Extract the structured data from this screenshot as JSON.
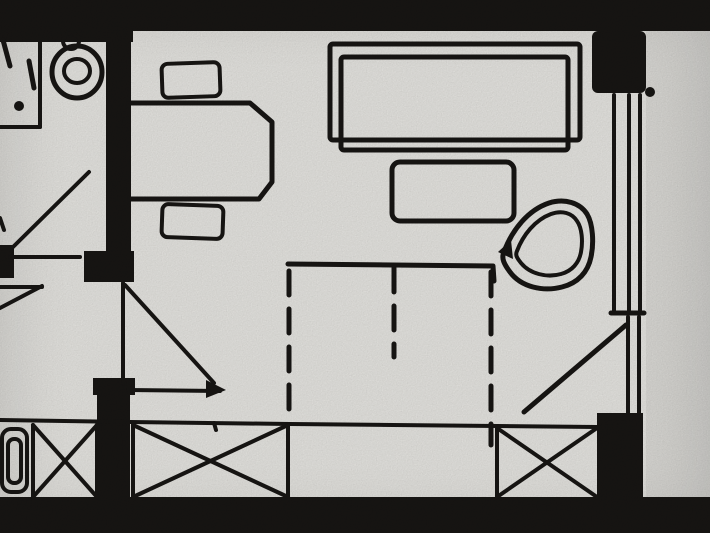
{
  "meta": {
    "title": "Scanned hand-drawn floor plan",
    "width": 710,
    "height": 533
  },
  "palette": {
    "paper": "#e9e8e4",
    "ink": "#181614",
    "right_strip": "rgba(20,18,16,0.05)"
  },
  "floor_plan": {
    "overlays": [
      {
        "name": "adjacent-bay-shading",
        "x": 646,
        "y": 31,
        "w": 64,
        "h": 466,
        "fill": "rgba(20,18,16,0.05)"
      }
    ],
    "walls": [
      {
        "name": "top-wall",
        "x": 0,
        "y": 0,
        "w": 710,
        "h": 31
      },
      {
        "name": "top-wall-left-thick",
        "x": 0,
        "y": 0,
        "w": 133,
        "h": 42
      },
      {
        "name": "window-pier-top",
        "x": 592,
        "y": 31,
        "w": 54,
        "h": 62,
        "rx": 6
      },
      {
        "name": "bath-room-divider-wall",
        "x": 106,
        "y": 31,
        "w": 25,
        "h": 223
      },
      {
        "name": "bath-door-jamb-right",
        "x": 84,
        "y": 251,
        "w": 50,
        "h": 31
      },
      {
        "name": "bath-door-jamb-left",
        "x": 0,
        "y": 245,
        "w": 14,
        "h": 33
      },
      {
        "name": "hall-room-wall-cap",
        "x": 93,
        "y": 378,
        "w": 42,
        "h": 17
      },
      {
        "name": "hall-room-wall",
        "x": 97,
        "y": 378,
        "w": 33,
        "h": 122
      },
      {
        "name": "balcony-pier-right",
        "x": 597,
        "y": 413,
        "w": 46,
        "h": 86
      },
      {
        "name": "bottom-wall",
        "x": 0,
        "y": 497,
        "w": 710,
        "h": 36
      }
    ],
    "strokes": [
      {
        "name": "bath-cubicle-side-line",
        "kind": "line",
        "x1": 40,
        "y1": 42,
        "x2": 40,
        "y2": 127,
        "w": 4
      },
      {
        "name": "bath-cubicle-bottom-line",
        "kind": "line",
        "x1": 0,
        "y1": 127,
        "x2": 40,
        "y2": 127,
        "w": 4
      },
      {
        "name": "toilet-fixture-mark-1",
        "kind": "line",
        "x1": 3,
        "y1": 40,
        "x2": 10,
        "y2": 66,
        "w": 5
      },
      {
        "name": "toilet-fixture-mark-2",
        "kind": "line",
        "x1": 29,
        "y1": 61,
        "x2": 34,
        "y2": 88,
        "w": 5
      },
      {
        "name": "washbasin-outer-bowl",
        "kind": "ellipse",
        "cx": 77,
        "cy": 72,
        "rx": 25,
        "ry": 26,
        "w": 5
      },
      {
        "name": "washbasin-inner-bowl",
        "kind": "ellipse",
        "cx": 77,
        "cy": 71,
        "rx": 13,
        "ry": 12,
        "w": 4
      },
      {
        "name": "washbasin-faucet",
        "kind": "ellipse",
        "cx": 71,
        "cy": 41,
        "rx": 8,
        "ry": 8,
        "w": 4
      },
      {
        "name": "bath-wall-edge-mark",
        "kind": "line",
        "x1": 0,
        "y1": 218,
        "x2": 4,
        "y2": 230,
        "w": 4
      },
      {
        "name": "bath-door-leaf",
        "kind": "line",
        "x1": 89,
        "y1": 172,
        "x2": 12,
        "y2": 248,
        "w": 4
      },
      {
        "name": "bath-door-chord",
        "kind": "line",
        "x1": 10,
        "y1": 257,
        "x2": 80,
        "y2": 257,
        "w": 4
      },
      {
        "name": "entry-door-chord",
        "kind": "line",
        "x1": 0,
        "y1": 287,
        "x2": 42,
        "y2": 287,
        "w": 4
      },
      {
        "name": "entry-door-swing",
        "kind": "line",
        "x1": 42,
        "y1": 286,
        "x2": 0,
        "y2": 308,
        "w": 4
      },
      {
        "name": "desk-outline",
        "kind": "path",
        "d": "M131,103 L250,103 L272,122 L272,182 L259,199 L131,199",
        "w": 5
      },
      {
        "name": "desk-chair-top",
        "kind": "rect",
        "x": 162,
        "y": 63,
        "w": 58,
        "h": 34,
        "rx": 6,
        "sw": 4,
        "rot": [
          -2,
          191,
          80
        ]
      },
      {
        "name": "desk-chair-bottom",
        "kind": "rect",
        "x": 162,
        "y": 205,
        "w": 61,
        "h": 33,
        "rx": 6,
        "sw": 4,
        "rot": [
          2,
          192,
          221
        ]
      },
      {
        "name": "sofa-outer-outline",
        "kind": "rect",
        "x": 330,
        "y": 44,
        "w": 250,
        "h": 96,
        "rx": 3,
        "sw": 5
      },
      {
        "name": "sofa-inner-outline",
        "kind": "rect",
        "x": 341,
        "y": 57,
        "w": 227,
        "h": 93,
        "rx": 3,
        "sw": 5
      },
      {
        "name": "side-table-outline",
        "kind": "rect",
        "x": 392,
        "y": 162,
        "w": 122,
        "h": 59,
        "rx": 8,
        "sw": 5
      },
      {
        "name": "armchair-outer-shell",
        "kind": "path",
        "d": "M504,252 C512,230 528,210 549,203 C565,198 580,203 587,214 C593,224 594,243 591,257 C588,272 578,283 562,287 C543,292 521,287 510,272 C504,264 501,258 504,252 Z",
        "w": 5
      },
      {
        "name": "armchair-inner-shell",
        "kind": "path",
        "d": "M517,251 C523,235 535,220 551,214 C562,210 572,213 577,221 C582,228 583,241 581,252 C579,263 572,271 561,274 C547,278 530,274 521,263 C517,258 515,255 517,251 Z",
        "w": 4
      },
      {
        "name": "window-glazing-line-1",
        "kind": "line",
        "x1": 614,
        "y1": 95,
        "x2": 614,
        "y2": 311,
        "w": 4
      },
      {
        "name": "window-glazing-line-2",
        "kind": "line",
        "x1": 629,
        "y1": 95,
        "x2": 629,
        "y2": 311,
        "w": 4
      },
      {
        "name": "window-glazing-line-3",
        "kind": "line",
        "x1": 640,
        "y1": 95,
        "x2": 640,
        "y2": 311,
        "w": 4
      },
      {
        "name": "window-sill-tick",
        "kind": "line",
        "x1": 611,
        "y1": 313,
        "x2": 644,
        "y2": 313,
        "w": 5
      },
      {
        "name": "balcony-door-frame-1",
        "kind": "line",
        "x1": 628,
        "y1": 317,
        "x2": 628,
        "y2": 413,
        "w": 4
      },
      {
        "name": "balcony-door-frame-2",
        "kind": "line",
        "x1": 639,
        "y1": 317,
        "x2": 639,
        "y2": 413,
        "w": 4
      },
      {
        "name": "balcony-door-swing",
        "kind": "line",
        "x1": 626,
        "y1": 325,
        "x2": 524,
        "y2": 412,
        "w": 5
      },
      {
        "name": "bed-head-edge",
        "kind": "polyline",
        "pts": "288,264 493,266 494,281",
        "w": 5
      },
      {
        "name": "bed-dashed-left-edge",
        "kind": "line",
        "x1": 289,
        "y1": 271,
        "x2": 289,
        "y2": 420,
        "w": 5,
        "dash": "24 14"
      },
      {
        "name": "bed-dashed-center-divider",
        "kind": "line",
        "x1": 394,
        "y1": 268,
        "x2": 394,
        "y2": 357,
        "w": 5,
        "dash": "24 14"
      },
      {
        "name": "bed-dashed-right-edge",
        "kind": "line",
        "x1": 491,
        "y1": 272,
        "x2": 491,
        "y2": 445,
        "w": 5,
        "dash": "24 14"
      },
      {
        "name": "balcony-rail-line",
        "kind": "polyline",
        "pts": "0,420 130,422 290,424 597,427",
        "w": 4
      },
      {
        "name": "rail-pen-mark",
        "kind": "line",
        "x1": 214,
        "y1": 423,
        "x2": 216,
        "y2": 430,
        "w": 4
      },
      {
        "name": "railing-panel-1-left",
        "kind": "line",
        "x1": 33,
        "y1": 425,
        "x2": 33,
        "y2": 497,
        "w": 4
      },
      {
        "name": "railing-panel-1-right",
        "kind": "line",
        "x1": 97,
        "y1": 425,
        "x2": 97,
        "y2": 497,
        "w": 4
      },
      {
        "name": "railing-panel-1-cross-a",
        "kind": "line",
        "x1": 33,
        "y1": 425,
        "x2": 97,
        "y2": 497,
        "w": 4
      },
      {
        "name": "railing-panel-1-cross-b",
        "kind": "line",
        "x1": 97,
        "y1": 425,
        "x2": 33,
        "y2": 497,
        "w": 4
      },
      {
        "name": "railing-panel-2-left",
        "kind": "line",
        "x1": 133,
        "y1": 425,
        "x2": 133,
        "y2": 497,
        "w": 4
      },
      {
        "name": "railing-panel-2-right",
        "kind": "line",
        "x1": 288,
        "y1": 425,
        "x2": 288,
        "y2": 497,
        "w": 4
      },
      {
        "name": "railing-panel-2-cross-a",
        "kind": "line",
        "x1": 133,
        "y1": 425,
        "x2": 288,
        "y2": 497,
        "w": 4
      },
      {
        "name": "railing-panel-2-cross-b",
        "kind": "line",
        "x1": 288,
        "y1": 425,
        "x2": 133,
        "y2": 497,
        "w": 4
      },
      {
        "name": "railing-panel-3-left",
        "kind": "line",
        "x1": 497,
        "y1": 428,
        "x2": 497,
        "y2": 497,
        "w": 4
      },
      {
        "name": "railing-panel-3-cross-a",
        "kind": "line",
        "x1": 497,
        "y1": 428,
        "x2": 597,
        "y2": 497,
        "w": 4
      },
      {
        "name": "railing-panel-3-cross-b",
        "kind": "line",
        "x1": 597,
        "y1": 428,
        "x2": 497,
        "y2": 497,
        "w": 4
      },
      {
        "name": "planter-outer-outline",
        "kind": "rect",
        "x": 2,
        "y": 429,
        "w": 25,
        "h": 63,
        "rx": 9,
        "sw": 4
      },
      {
        "name": "planter-inner-outline",
        "kind": "rect",
        "x": 8,
        "y": 439,
        "w": 13,
        "h": 44,
        "rx": 6,
        "sw": 4
      },
      {
        "name": "room-door-leaf",
        "kind": "line",
        "x1": 123,
        "y1": 283,
        "x2": 123,
        "y2": 384,
        "w": 4
      },
      {
        "name": "room-door-swing",
        "kind": "line",
        "x1": 125,
        "y1": 285,
        "x2": 214,
        "y2": 383,
        "w": 4
      },
      {
        "name": "room-door-chord",
        "kind": "line",
        "x1": 128,
        "y1": 390,
        "x2": 220,
        "y2": 391,
        "w": 4
      }
    ],
    "fills": [
      {
        "name": "toilet-fixture-dot",
        "kind": "circle",
        "cx": 19,
        "cy": 106,
        "r": 5
      },
      {
        "name": "window-corner-dot",
        "kind": "circle",
        "cx": 650,
        "cy": 92,
        "r": 5
      },
      {
        "name": "armchair-tip-blob",
        "kind": "polygon",
        "pts": "498,252 511,240 513,259"
      },
      {
        "name": "room-door-arrowhead",
        "kind": "polygon",
        "pts": "226,390 206,380 206,398"
      }
    ]
  }
}
